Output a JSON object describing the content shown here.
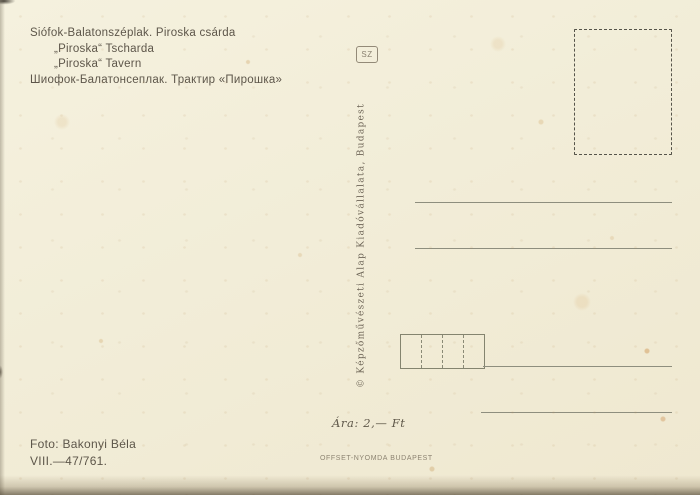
{
  "captions": {
    "hu": "Siófok-Balatonszéplak. Piroska csárda",
    "de": "„Piroska“ Tscharda",
    "en": "„Piroska“ Tavern",
    "ru": "Шиофок-Балатонсеплак. Трактир «Пирошка»"
  },
  "publisher": {
    "mark": "SZ",
    "imprint": "© Képzőművészeti Alap Kiadóvállalata, Budapest"
  },
  "price": "Ára: 2,— Ft",
  "printer": "OFFSET-NYOMDA BUDAPEST",
  "photo_credit": "Foto: Bakonyi Béla",
  "catalog_number": "VIII.—47/761.",
  "postal_code_box": {
    "cells": 4
  },
  "colors": {
    "paper": "#f2edd8",
    "ink": "#5d564a",
    "rule": "#8e8e7e"
  }
}
